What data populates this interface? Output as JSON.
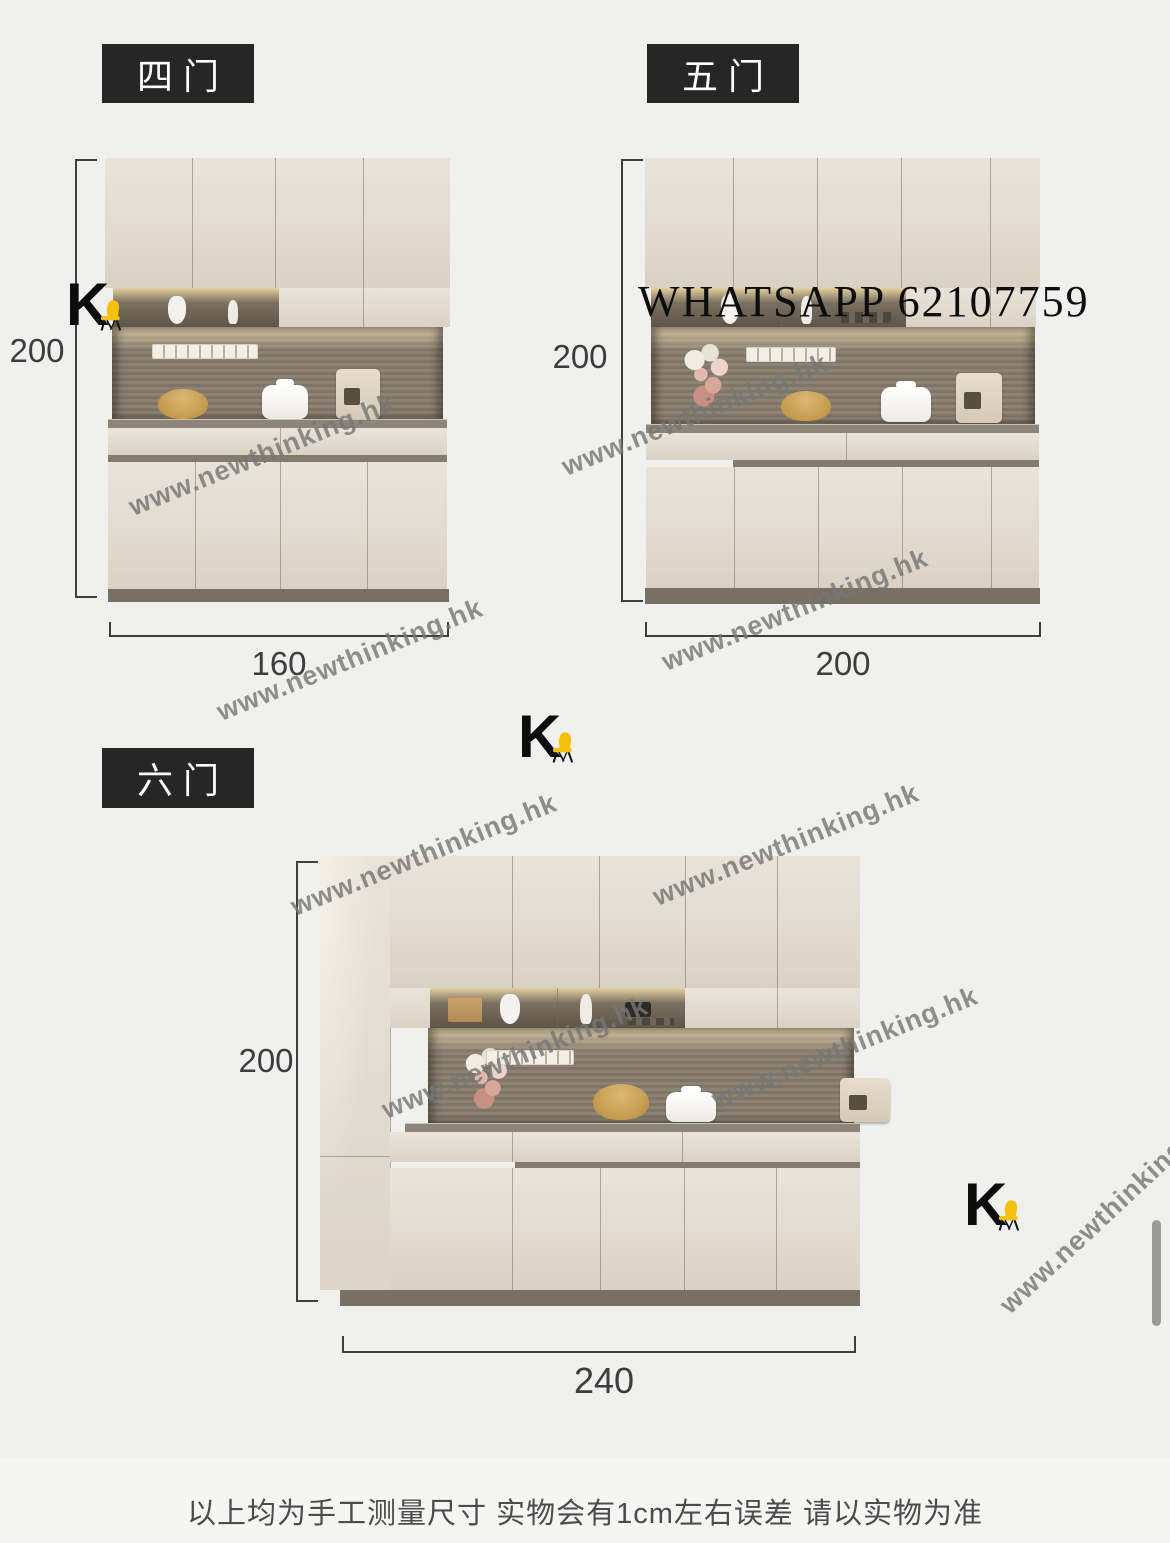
{
  "brand": {
    "letter": "K",
    "chair_color": "#f4c20d"
  },
  "watermark": {
    "text": "www.newthinking.hk"
  },
  "overlay": {
    "whatsapp": "WHATSAPP 62107759"
  },
  "sections": [
    {
      "label": "四门",
      "height": "200",
      "width": "160"
    },
    {
      "label": "五门",
      "height": "200",
      "width": "200"
    },
    {
      "label": "六门",
      "height": "200",
      "width": "240"
    }
  ],
  "footer": {
    "disclaimer": "以上均为手工测量尺寸 实物会有1cm左右误差 请以实物为准"
  }
}
